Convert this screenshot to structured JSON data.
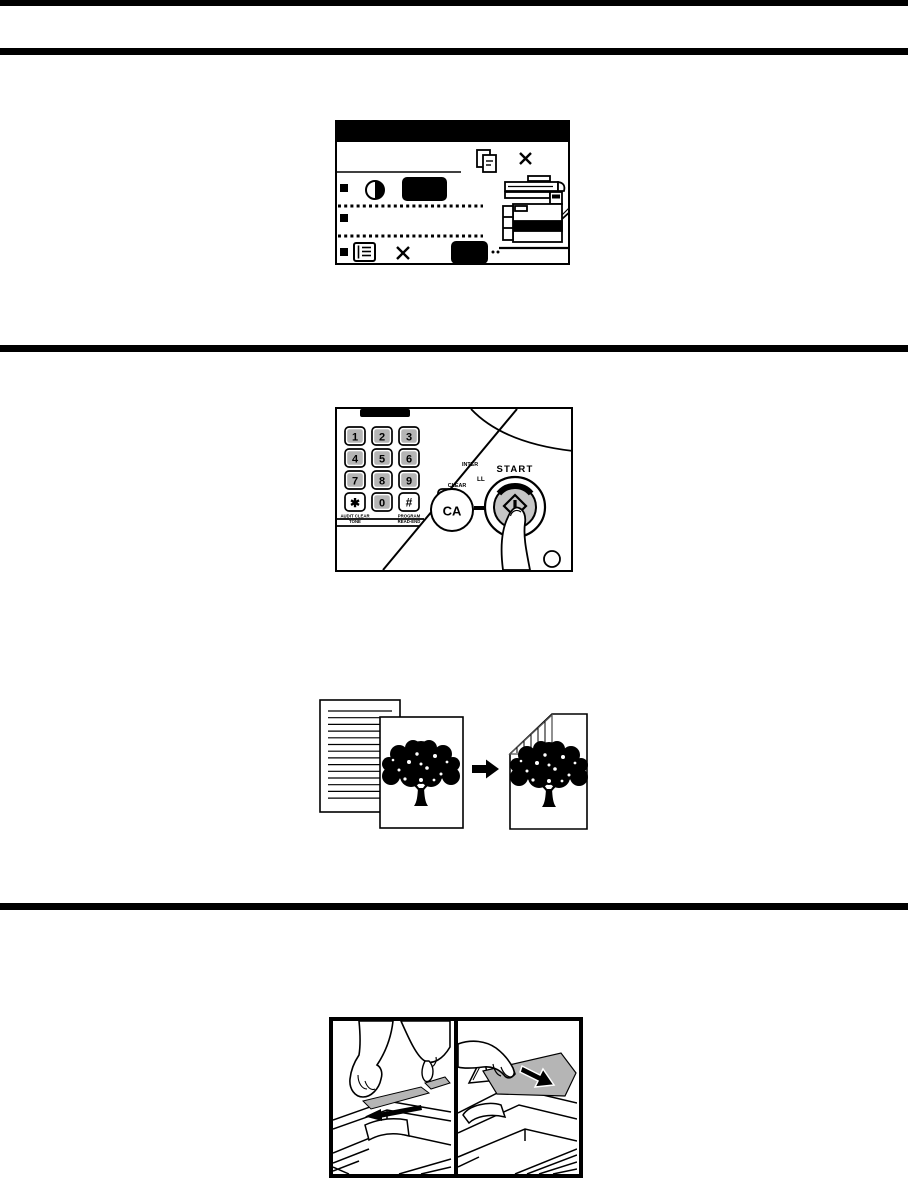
{
  "page": {
    "kind": "copier-manual-scan"
  },
  "colors": {
    "ink": "#000000",
    "background": "#ffffff",
    "key_gray": "#b5b5b5",
    "start_button_gray": "#c6c6c6",
    "original_paper_gray": "#b5b5b5"
  },
  "lcd_figure": {
    "icons": [
      "copy-pages-icon",
      "close-icon",
      "contrast-icon",
      "list-icon",
      "copier-icon"
    ]
  },
  "keypad_figure": {
    "keys": [
      [
        "1",
        "2",
        "3"
      ],
      [
        "4",
        "5",
        "6"
      ],
      [
        "7",
        "8",
        "9"
      ],
      [
        "✱",
        "0",
        "#"
      ]
    ],
    "labels": {
      "audit_clear": "AUDIT CLEAR",
      "tone": "TONE",
      "program": "PROGRAM",
      "read_end": "READ-END",
      "clear": "CLEAR",
      "c": "C",
      "ca": "CA",
      "interrupt_partial": "INTER",
      "clear_all_partial": "LL",
      "start": "START"
    }
  },
  "duplex_figure": {
    "icons": [
      "lined-original-page",
      "photo-original-page",
      "arrow-right",
      "two-sided-copy-page"
    ]
  },
  "feeder_figure": {
    "panels": [
      "adjust-original-guides-photo",
      "insert-originals-photo"
    ]
  }
}
